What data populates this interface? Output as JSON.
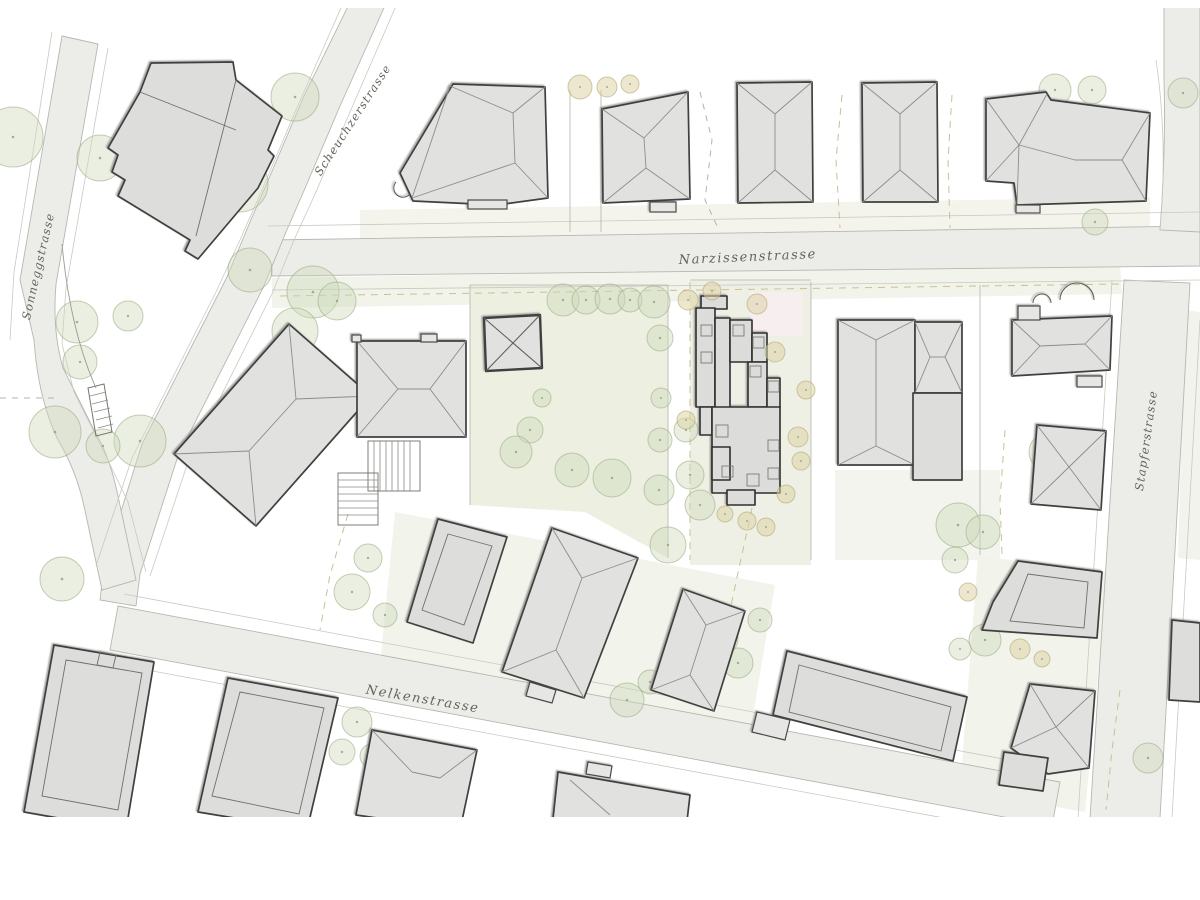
{
  "title": "Architectural site plan",
  "streets": {
    "scheuchzerstrasse": "Scheuchzerstrasse",
    "sonneggstrasse": "Sonneggstrasse",
    "narzissenstrasse": "Narzissenstrasse",
    "stapferstrasse": "Stapferstrasse",
    "nelkenstrasse": "Nelkenstrasse"
  },
  "colors": {
    "background": "#ffffff",
    "street_fill": "#ecede8",
    "garden_fill": "#edefe1",
    "project_parcel_fill": "#eff0e5",
    "parcel_tint": "#f2f3eb",
    "highlight_pink": "#f7eef0",
    "building_fill": "#e1e1e0",
    "building_outline": "#3f3f3f",
    "roofline": "#8d8d8a",
    "project_fill": "#dcdcda",
    "project_outline": "#2e2e2e",
    "tree_green": "#cdd8ba",
    "tree_green_outline": "#97a87e",
    "tree_tan": "#ded4a8",
    "dashed_boundary_tan": "#cbbf96",
    "label_color": "#63635c"
  }
}
